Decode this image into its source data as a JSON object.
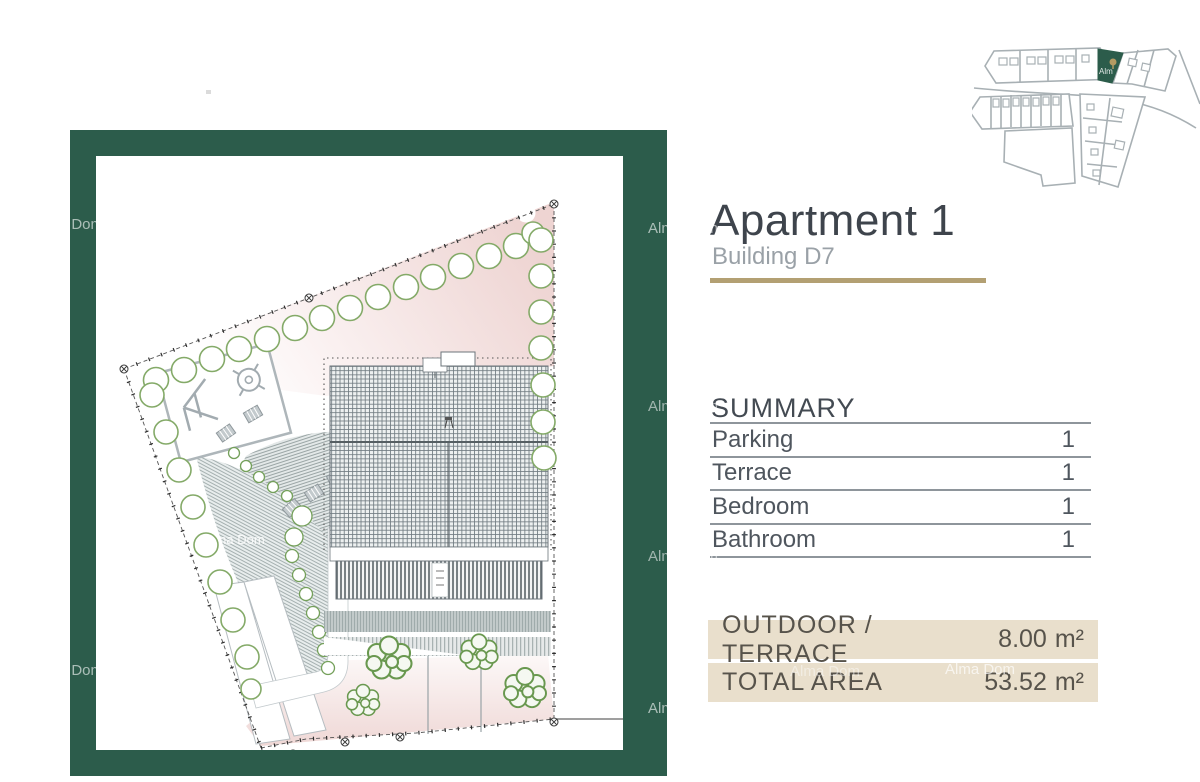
{
  "header": {
    "title": "Apartment 1",
    "subtitle": "Building D7"
  },
  "summary": {
    "heading": "SUMMARY",
    "rows": [
      {
        "label": "Parking",
        "value": "1"
      },
      {
        "label": "Terrace",
        "value": "1"
      },
      {
        "label": "Bedroom",
        "value": "1"
      },
      {
        "label": "Bathroom",
        "value": "1"
      }
    ]
  },
  "totals": {
    "rows": [
      {
        "label": "OUTDOOR / TERRACE",
        "value": "8.00",
        "unit": "m²"
      },
      {
        "label": "TOTAL AREA",
        "value": "53.52",
        "unit": "m²"
      }
    ]
  },
  "watermark": {
    "text": "Alma Dom",
    "short": "Alm"
  },
  "icons": {
    "site_plan": "site-plan-drawing",
    "minimap": "site-location-minimap",
    "highlighted_plot": "building-d7-plot"
  },
  "colors": {
    "frame_green": "#2c5c4b",
    "accent_gold": "#b3a073",
    "bar_beige": "#e9dfcc",
    "title_color": "#3e444c",
    "subtitle_gray": "#9aa1a7",
    "text_gray": "#4f565e",
    "bar_text": "#57534b",
    "rule_gray": "#8e959b",
    "plan_pink": "#f0d9d7",
    "tree_green": "#84aa68",
    "bush_green": "#69984f",
    "drawing_gray": "#9aa3a8"
  }
}
